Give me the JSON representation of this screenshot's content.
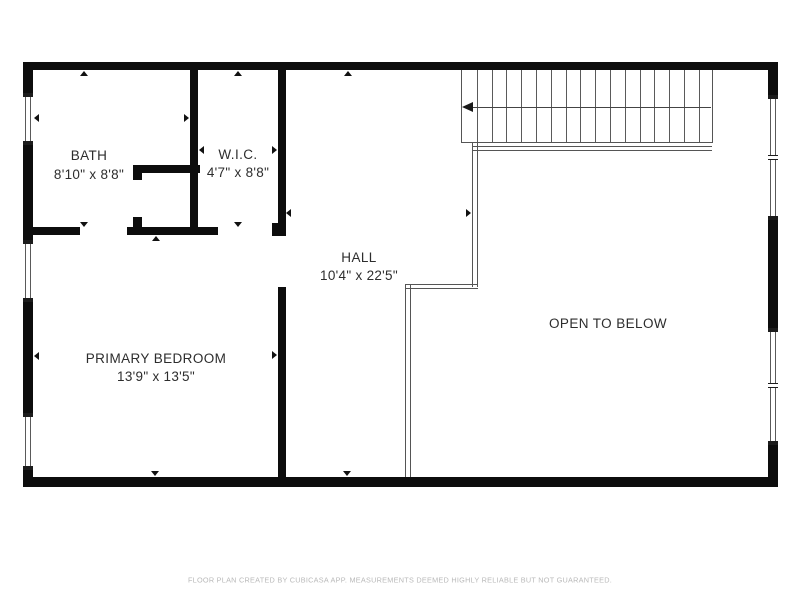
{
  "plan": {
    "title": "Second floor plan",
    "wall_color": "#0d0d0d",
    "line_color": "#555555",
    "text_color": "#2d2d2d",
    "footer_color": "#b9b9b9"
  },
  "rooms": [
    {
      "name": "BATH",
      "dims": "8'10\" x 8'8\"",
      "cx": 89,
      "cy": 165
    },
    {
      "name": "W.I.C.",
      "dims": "4'7\" x 8'8\"",
      "cx": 238,
      "cy": 163.5
    },
    {
      "name": "HALL",
      "dims": "10'4\" x 22'5\"",
      "cx": 359,
      "cy": 266.5
    },
    {
      "name": "PRIMARY BEDROOM",
      "dims": "13'9\" x 13'5\"",
      "cx": 156,
      "cy": 367.5
    },
    {
      "name": "OPEN TO BELOW",
      "dims": "",
      "cx": 608,
      "cy": 324
    }
  ],
  "footer": {
    "text": "FLOOR PLAN CREATED BY CUBICASA APP. MEASUREMENTS DEEMED HIGHLY RELIABLE BUT NOT GUARANTEED."
  },
  "walls": [
    {
      "name": "exterior-wall-top",
      "x": 23,
      "y": 62,
      "w": 754,
      "h": 8
    },
    {
      "name": "exterior-wall-bottom",
      "x": 23,
      "y": 477,
      "w": 754,
      "h": 10
    },
    {
      "name": "exterior-wall-left",
      "x": 23,
      "y": 62,
      "w": 10,
      "h": 425
    },
    {
      "name": "exterior-wall-right",
      "x": 768,
      "y": 62,
      "w": 10,
      "h": 425
    },
    {
      "name": "wall-bath-wic",
      "x": 190,
      "y": 70,
      "w": 8,
      "h": 165
    },
    {
      "name": "wall-wic-hall-upper",
      "x": 277.5,
      "y": 70,
      "w": 8,
      "h": 162
    },
    {
      "name": "wall-bedroom-hall-lower",
      "x": 277.5,
      "y": 287,
      "w": 8,
      "h": 190
    },
    {
      "name": "wall-bath-bedroom-a",
      "x": 23,
      "y": 227,
      "w": 57,
      "h": 8
    },
    {
      "name": "wall-bath-bedroom-b",
      "x": 127,
      "y": 227,
      "w": 91,
      "h": 8
    },
    {
      "name": "wall-junction-wic-hall",
      "x": 272,
      "y": 223,
      "w": 14,
      "h": 13
    },
    {
      "name": "wall-shower-top",
      "x": 133,
      "y": 165,
      "w": 67,
      "h": 8
    },
    {
      "name": "wall-shower-left-stub-top",
      "x": 133,
      "y": 165,
      "w": 9,
      "h": 15
    },
    {
      "name": "wall-shower-left-stub-bot",
      "x": 133,
      "y": 217,
      "w": 9,
      "h": 18
    }
  ],
  "windows": [
    {
      "name": "window-bath-left",
      "x": 23,
      "y": 93,
      "thick": 10,
      "len": 52,
      "divider": null
    },
    {
      "name": "window-bedroom-left-1",
      "x": 23,
      "y": 240,
      "thick": 10,
      "len": 62,
      "divider": null
    },
    {
      "name": "window-bedroom-left-2",
      "x": 23,
      "y": 413,
      "thick": 10,
      "len": 57,
      "divider": null
    },
    {
      "name": "window-right-upper",
      "x": 768,
      "y": 95,
      "thick": 10,
      "len": 125,
      "divider": 60
    },
    {
      "name": "window-right-lower",
      "x": 768,
      "y": 328,
      "thick": 10,
      "len": 117,
      "divider": 55
    }
  ],
  "stairs": {
    "x": 461,
    "y": 70,
    "w": 251.5,
    "h": 73,
    "treads": 17,
    "arrow_y": 106.5,
    "arrow_x1": 467,
    "arrow_x2": 711,
    "head_x": 461.5
  },
  "open_below_boundary": [
    {
      "name": "boundary-under-stairs",
      "type": "h",
      "x": 472,
      "y": 146,
      "w": 240,
      "h": 5
    },
    {
      "name": "boundary-vertical-1",
      "type": "v",
      "x": 471.5,
      "y": 143,
      "w": 6,
      "h": 144
    },
    {
      "name": "boundary-horizontal-2",
      "type": "h",
      "x": 405,
      "y": 283.5,
      "w": 73,
      "h": 5.5
    },
    {
      "name": "boundary-vertical-2",
      "type": "v",
      "x": 405,
      "y": 283.5,
      "w": 5.5,
      "h": 193.5
    }
  ],
  "extent_markers": [
    {
      "room": "bath",
      "dir": "up",
      "x": 84,
      "y": 71
    },
    {
      "room": "bath",
      "dir": "left",
      "x": 34,
      "y": 118
    },
    {
      "room": "bath",
      "dir": "right",
      "x": 189,
      "y": 118
    },
    {
      "room": "bath",
      "dir": "down",
      "x": 84,
      "y": 227
    },
    {
      "room": "wic",
      "dir": "up",
      "x": 238,
      "y": 71
    },
    {
      "room": "wic",
      "dir": "left",
      "x": 199,
      "y": 150
    },
    {
      "room": "wic",
      "dir": "right",
      "x": 277,
      "y": 150
    },
    {
      "room": "wic",
      "dir": "down",
      "x": 238,
      "y": 227
    },
    {
      "room": "hall",
      "dir": "up",
      "x": 348,
      "y": 71
    },
    {
      "room": "hall",
      "dir": "left",
      "x": 286,
      "y": 213
    },
    {
      "room": "hall",
      "dir": "right",
      "x": 471,
      "y": 213
    },
    {
      "room": "hall",
      "dir": "down",
      "x": 347,
      "y": 476
    },
    {
      "room": "bedroom",
      "dir": "up",
      "x": 156,
      "y": 236
    },
    {
      "room": "bedroom",
      "dir": "left",
      "x": 34,
      "y": 356
    },
    {
      "room": "bedroom",
      "dir": "right",
      "x": 277,
      "y": 355
    },
    {
      "room": "bedroom",
      "dir": "down",
      "x": 155,
      "y": 476
    }
  ]
}
